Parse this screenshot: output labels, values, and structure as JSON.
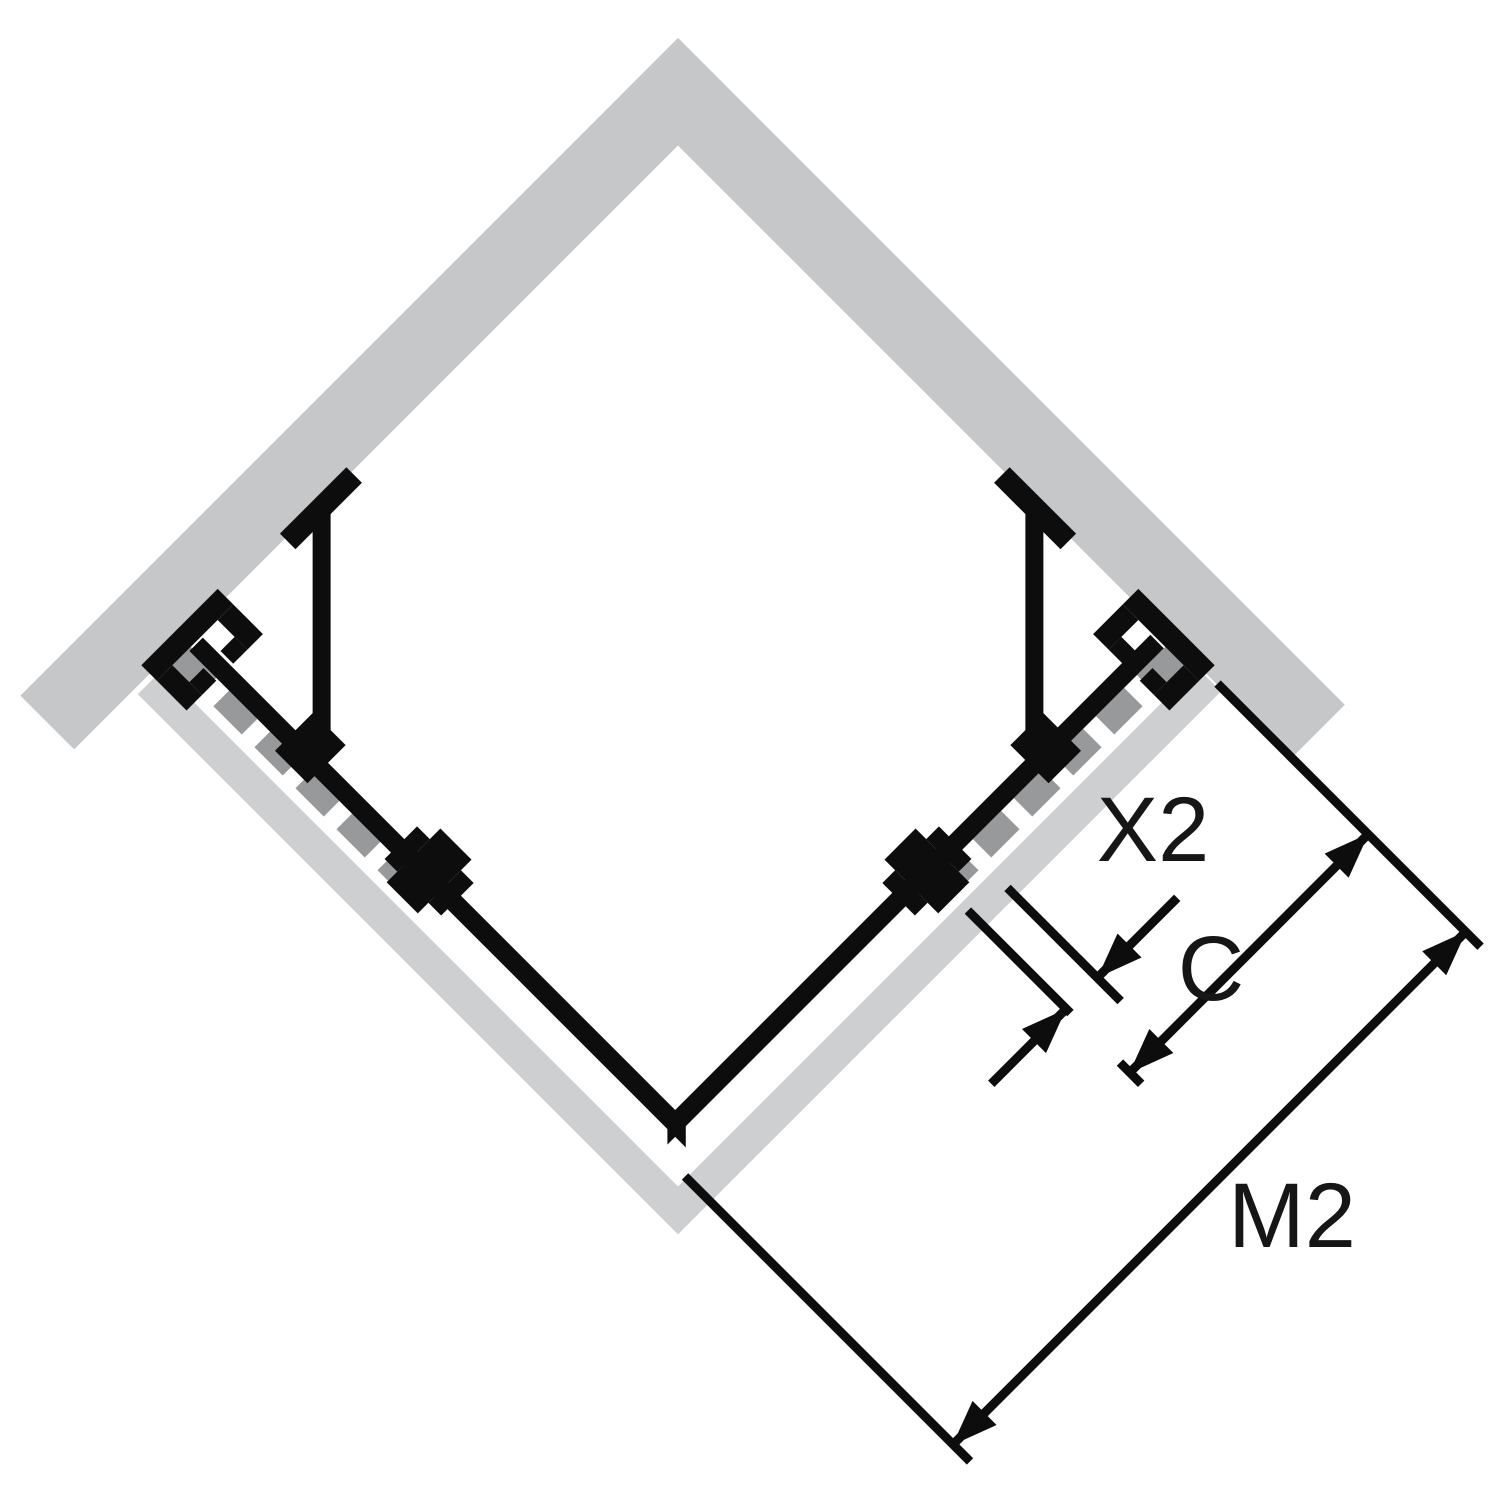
{
  "diagram": {
    "type": "technical-installation-drawing",
    "subject": "corner-entry shower enclosure, top view (plan), walls at 90 degrees with two hinged glass panels and dimension lines",
    "labels": {
      "x2": "X2",
      "c": "C",
      "m2": "M2"
    },
    "colors": {
      "background": "#ffffff",
      "wall_gray": "#c5c7c9",
      "tray_gray": "#cdcfd1",
      "dash_gray": "#98999b",
      "line_black": "#0d0d0d",
      "text_black": "#161616"
    }
  }
}
